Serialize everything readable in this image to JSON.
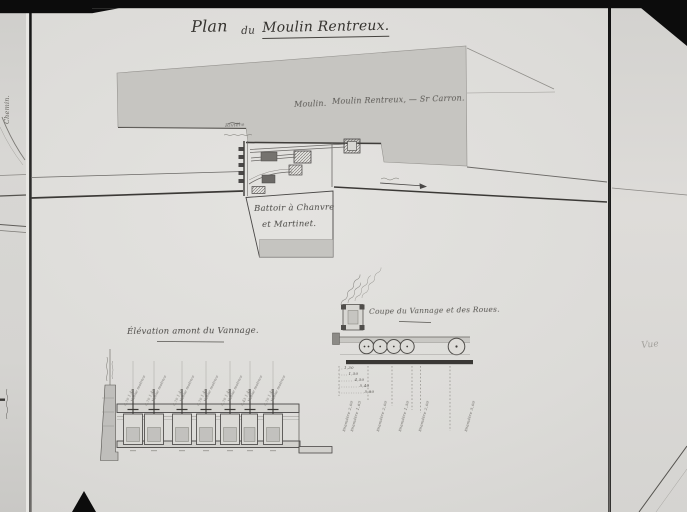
{
  "title": {
    "word1": "Plan",
    "word2": "du",
    "word3": "Moulin Rentreux."
  },
  "plan_labels": {
    "mill_prefix": "Moulin.",
    "mill_name": "Moulin Rentreux, — Sr Carron.",
    "river": "Rivière",
    "battoir_line1": "Battoir à Chanvre",
    "battoir_line2": "et Martinet."
  },
  "elevation": {
    "title": "Élévation amont du Vannage.",
    "gates": [
      {
        "label": "Vanne motrice",
        "dims": "0,70  1,40"
      },
      {
        "label": "Vanne motrice",
        "dims": "0,70  1,40"
      },
      {
        "label": "Vanne motrice",
        "dims": "0,70  1,40"
      },
      {
        "label": "Vanne motrice",
        "dims": "0,70  1,40"
      },
      {
        "label": "Vanne motrice",
        "dims": "0,70  1,40"
      },
      {
        "label": "Vanne motrice",
        "dims": "0,45  1,40"
      },
      {
        "label": "Vanne motrice",
        "dims": "0,70  1,40"
      }
    ]
  },
  "coupe": {
    "title": "Coupe du Vannage et des Roues.",
    "distances": [
      "1,30",
      "1,50",
      "4,50",
      "5,40",
      "5,80"
    ],
    "diameters": [
      "Diamètre 2,00",
      "Diamètre 1,65",
      "Diamètre 2,00",
      "Diamètre 1,50",
      "Diamètre 2,00",
      "Diamètre 5,00"
    ]
  },
  "margins": {
    "left_label": "Chemin.",
    "right_label": "Vue"
  }
}
